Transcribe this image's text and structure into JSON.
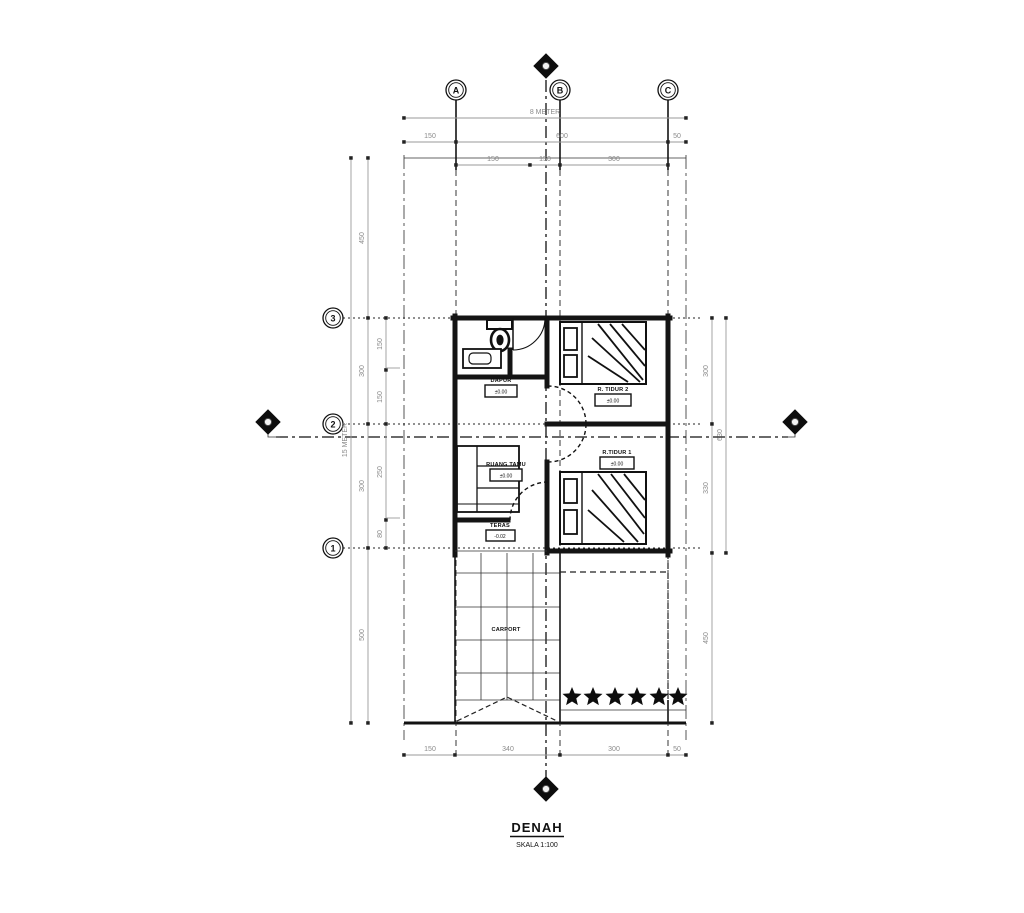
{
  "drawing": {
    "title": "DENAH",
    "scale": "SKALA 1:100",
    "grid_columns": [
      "A",
      "B",
      "C"
    ],
    "grid_rows": [
      "3",
      "2",
      "1"
    ],
    "rooms": {
      "dapur": {
        "name": "DAPUR",
        "elev": "±0.00"
      },
      "r_tidur_2": {
        "name": "R. TIDUR 2",
        "elev": "±0.00"
      },
      "ruang_tamu": {
        "name": "RUANG TAMU",
        "elev": "±0.00"
      },
      "r_tidur_1": {
        "name": "R.TIDUR 1",
        "elev": "±0.00"
      },
      "teras": {
        "name": "TERAS",
        "elev": "-0.02"
      },
      "carport": {
        "name": "CARPORT"
      }
    },
    "dimensions": {
      "top_overall": "8 METER",
      "left_overall": "15 METER",
      "top_row2": [
        "150",
        "600",
        "50"
      ],
      "top_row3": [
        "150",
        "150",
        "300"
      ],
      "left_seg": [
        "450",
        "300",
        "300",
        "500"
      ],
      "left_sub": [
        "150",
        "150",
        "250",
        "80"
      ],
      "right_seg": [
        "300",
        "330",
        "450"
      ],
      "right_overall": "630",
      "bottom": [
        "150",
        "340",
        "300",
        "50"
      ]
    },
    "colors": {
      "line": "#141414",
      "dim": "#8a8a8a",
      "background": "#ffffff"
    }
  }
}
